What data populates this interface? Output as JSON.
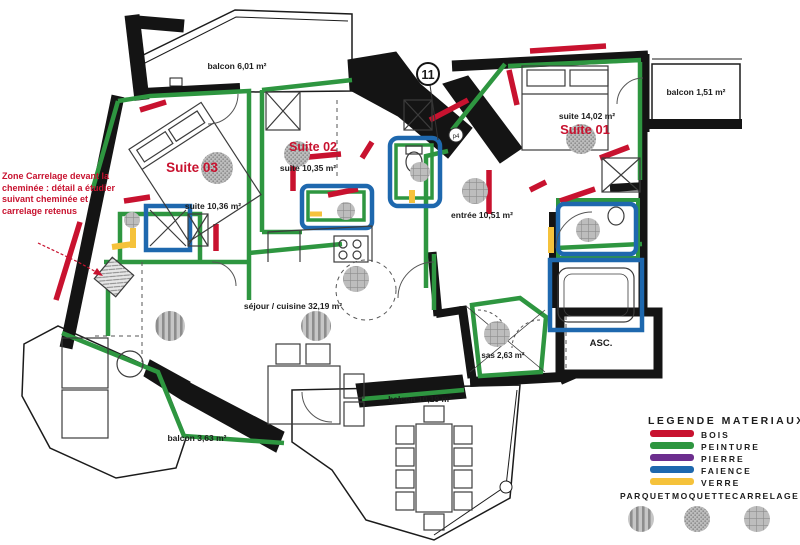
{
  "plan": {
    "marker": "11",
    "sub_marker": "p4",
    "note": "Zone Carrelage devant la cheminée : détail a étudier suivant cheminée et carrelage retenus",
    "rooms": {
      "suite01": {
        "label": "Suite 01",
        "area": "suite 14,02 m²"
      },
      "suite02": {
        "label": "Suite 02",
        "area": "suite 10,35 m²"
      },
      "suite03": {
        "label": "Suite 03",
        "area": "suite 10,36 m²"
      },
      "entree": {
        "label": "entrée 10,51 m²"
      },
      "sejour": {
        "label": "séjour / cuisine 32,19 m²"
      },
      "sas": {
        "label": "sas 2,63 m²"
      },
      "asc": {
        "label": "ASC."
      },
      "balcon_nw": {
        "label": "balcon 6,01 m²"
      },
      "balcon_ne": {
        "label": "balcon 1,51 m²"
      },
      "balcon_sw": {
        "label": "balcon 3,63 m²"
      },
      "balcon_s": {
        "label": "balcon 10,19 m²"
      }
    }
  },
  "legend": {
    "title": "LEGENDE MATERIAUX",
    "materials": [
      {
        "label": "BOIS",
        "color": "#c8122f"
      },
      {
        "label": "PEINTURE",
        "color": "#2e9640"
      },
      {
        "label": "PIERRE",
        "color": "#6c2e8e"
      },
      {
        "label": "FAIENCE",
        "color": "#1e68ae"
      },
      {
        "label": "VERRE",
        "color": "#f5c23b"
      }
    ],
    "floors": [
      {
        "label": "PARQUET",
        "pattern": "stripes"
      },
      {
        "label": "MOQUETTE",
        "pattern": "dots"
      },
      {
        "label": "CARRELAGE",
        "pattern": "grid"
      }
    ]
  }
}
